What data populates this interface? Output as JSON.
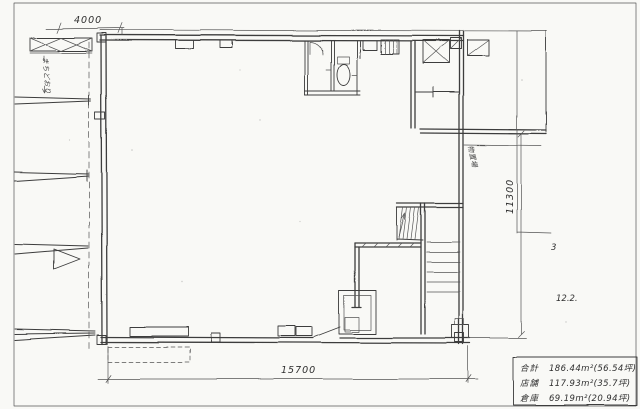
{
  "drawing": {
    "dimensions": {
      "top_left": "4000",
      "bottom": "15700",
      "right": "11300"
    },
    "notes": {
      "right_small": "3",
      "right_number": "12.2."
    },
    "street_label_vertical": "まちどおり",
    "stair_annotation_vertical": "物置場",
    "area_table": {
      "rows": [
        {
          "label": "合計",
          "value": "186.44m²(56.54坪)"
        },
        {
          "label": "店舗",
          "value": "117.93m²(35.7坪)"
        },
        {
          "label": "倉庫",
          "value": "69.19m²(20.94坪)"
        }
      ]
    }
  }
}
